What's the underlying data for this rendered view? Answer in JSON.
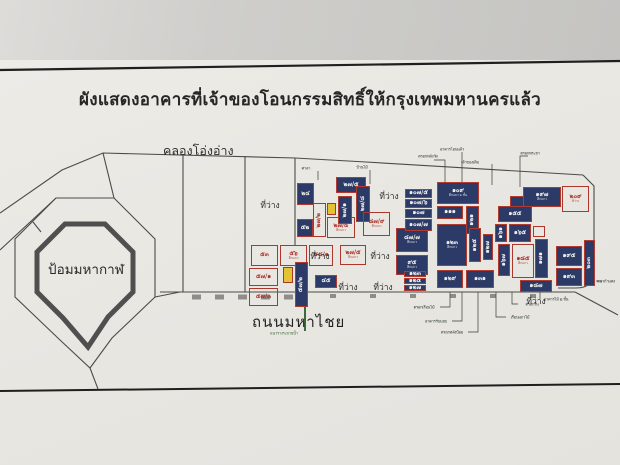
{
  "title": "ผังแสดงอาคารที่เจ้าของโอนกรรมสิทธิ์ให้กรุงเทพมหานครแล้ว",
  "labels": {
    "canal": "คลองโอ่งอ่าง",
    "fort": "ป้อมมหากาฬ",
    "road": "ถนนมหาไชย",
    "vacant": "ที่ว่าง"
  },
  "colors": {
    "navy_fill": "#2b3a66",
    "red_outline": "#ad372c",
    "yellow_highlight": "#e4c332",
    "line": "#4b4b49",
    "paper": "#e8e6e1",
    "wall": "#cbc9c6",
    "green_mark": "#3a6b3a"
  },
  "map": {
    "plots": [
      {
        "x": 297,
        "y": 183,
        "w": 17,
        "h": 22,
        "t": "n",
        "label": "๒๔"
      },
      {
        "x": 297,
        "y": 219,
        "w": 16,
        "h": 18,
        "t": "n",
        "label": "๕๒"
      },
      {
        "x": 313,
        "y": 203,
        "w": 13,
        "h": 34,
        "t": "r",
        "label": "๒๗/๒",
        "rot": 1
      },
      {
        "x": 327,
        "y": 203,
        "w": 9,
        "h": 12,
        "t": "y",
        "label": ""
      },
      {
        "x": 327,
        "y": 217,
        "w": 28,
        "h": 21,
        "t": "r",
        "label": "๒๗/๔",
        "sub": "ตึกแถว"
      },
      {
        "x": 336,
        "y": 177,
        "w": 30,
        "h": 16,
        "t": "n",
        "label": "๒๗/๕"
      },
      {
        "x": 338,
        "y": 196,
        "w": 14,
        "h": 28,
        "t": "n",
        "label": "๒๗/๑",
        "rot": 1
      },
      {
        "x": 251,
        "y": 245,
        "w": 27,
        "h": 21,
        "t": "r",
        "label": "๕๓"
      },
      {
        "x": 280,
        "y": 245,
        "w": 27,
        "h": 21,
        "t": "r",
        "label": "๕๖",
        "sub": "ตึกแถว"
      },
      {
        "x": 309,
        "y": 245,
        "w": 24,
        "h": 21,
        "t": "r",
        "label": "๕๘/๑"
      },
      {
        "x": 249,
        "y": 268,
        "w": 29,
        "h": 18,
        "t": "r",
        "label": "๕๗/๑"
      },
      {
        "x": 249,
        "y": 288,
        "w": 29,
        "h": 18,
        "t": "r",
        "label": "๕๗/๓"
      },
      {
        "x": 283,
        "y": 267,
        "w": 10,
        "h": 16,
        "t": "y",
        "label": ""
      },
      {
        "x": 295,
        "y": 262,
        "w": 13,
        "h": 45,
        "t": "n",
        "label": "๕๗/๒",
        "rot": 1
      },
      {
        "x": 340,
        "y": 245,
        "w": 26,
        "h": 20,
        "t": "r",
        "label": "๒๗/๕",
        "sub": "ตึกแถว"
      },
      {
        "x": 315,
        "y": 275,
        "w": 22,
        "h": 13,
        "t": "n",
        "label": "๔๕"
      },
      {
        "x": 356,
        "y": 186,
        "w": 14,
        "h": 36,
        "t": "n",
        "label": "๒๗/๘",
        "rot": 1
      },
      {
        "x": 363,
        "y": 212,
        "w": 27,
        "h": 24,
        "t": "r",
        "label": "๘๗/๙",
        "sub": "ตึกแถว"
      },
      {
        "x": 396,
        "y": 228,
        "w": 32,
        "h": 24,
        "t": "n",
        "label": "๘๗/๗",
        "sub": "ตึกแถว"
      },
      {
        "x": 396,
        "y": 255,
        "w": 32,
        "h": 20,
        "t": "n",
        "label": "๙๕",
        "sub": "ตึกแถว"
      },
      {
        "x": 405,
        "y": 189,
        "w": 27,
        "h": 9,
        "t": "n",
        "label": "๑๐๗/๕"
      },
      {
        "x": 405,
        "y": 199,
        "w": 27,
        "h": 9,
        "t": "n",
        "label": "๑๐๗/๖"
      },
      {
        "x": 405,
        "y": 209,
        "w": 27,
        "h": 9,
        "t": "n",
        "label": "๑๐๗"
      },
      {
        "x": 405,
        "y": 219,
        "w": 27,
        "h": 12,
        "t": "n",
        "label": "๑๐๗/๗"
      },
      {
        "x": 404,
        "y": 271,
        "w": 22,
        "h": 6,
        "t": "n",
        "label": "๑๒๓"
      },
      {
        "x": 404,
        "y": 278,
        "w": 22,
        "h": 6,
        "t": "n",
        "label": "๑๒๕"
      },
      {
        "x": 404,
        "y": 285,
        "w": 22,
        "h": 6,
        "t": "n",
        "label": "๑๒๗"
      },
      {
        "x": 437,
        "y": 182,
        "w": 42,
        "h": 22,
        "t": "n",
        "label": "๑๐๙",
        "sub": "ตึกแถว ๒ ชั้น"
      },
      {
        "x": 437,
        "y": 206,
        "w": 26,
        "h": 13,
        "t": "n",
        "label": "๑๑๑"
      },
      {
        "x": 466,
        "y": 206,
        "w": 13,
        "h": 28,
        "t": "n",
        "label": "๑๒๑",
        "rot": 1
      },
      {
        "x": 437,
        "y": 224,
        "w": 30,
        "h": 42,
        "t": "n",
        "label": "๑๒๓",
        "sub": "ตึกแถว"
      },
      {
        "x": 469,
        "y": 228,
        "w": 12,
        "h": 34,
        "t": "n",
        "label": "๑๒๕",
        "rot": 1
      },
      {
        "x": 483,
        "y": 234,
        "w": 10,
        "h": 26,
        "t": "n",
        "label": "๑๒๗",
        "rot": 1
      },
      {
        "x": 437,
        "y": 270,
        "w": 26,
        "h": 18,
        "t": "n",
        "label": "๑๒๙"
      },
      {
        "x": 466,
        "y": 270,
        "w": 28,
        "h": 18,
        "t": "n",
        "label": "๑๓๑"
      },
      {
        "x": 498,
        "y": 206,
        "w": 34,
        "h": 16,
        "t": "n",
        "label": "๑๕๕"
      },
      {
        "x": 495,
        "y": 224,
        "w": 12,
        "h": 18,
        "t": "n",
        "label": "๑๖๑",
        "rot": 1
      },
      {
        "x": 509,
        "y": 224,
        "w": 22,
        "h": 18,
        "t": "n",
        "label": "๑๖๕"
      },
      {
        "x": 533,
        "y": 226,
        "w": 12,
        "h": 11,
        "t": "r",
        "label": ""
      },
      {
        "x": 535,
        "y": 239,
        "w": 13,
        "h": 39,
        "t": "n",
        "label": "๑๗๑",
        "rot": 1
      },
      {
        "x": 498,
        "y": 244,
        "w": 12,
        "h": 32,
        "t": "n",
        "label": "๑๖๗",
        "rot": 1
      },
      {
        "x": 512,
        "y": 244,
        "w": 22,
        "h": 34,
        "t": "r",
        "label": "๑๘๕",
        "sub": "ตึกแถว"
      },
      {
        "x": 523,
        "y": 187,
        "w": 38,
        "h": 20,
        "t": "n",
        "label": "๑๙๗",
        "sub": "ตึกแถว"
      },
      {
        "x": 510,
        "y": 196,
        "w": 14,
        "h": 11,
        "t": "n",
        "label": ""
      },
      {
        "x": 562,
        "y": 186,
        "w": 27,
        "h": 26,
        "t": "r",
        "label": "๒๐๙",
        "sub": "ที่ว่าง"
      },
      {
        "x": 556,
        "y": 246,
        "w": 26,
        "h": 20,
        "t": "n",
        "label": "๑๙๕"
      },
      {
        "x": 556,
        "y": 268,
        "w": 26,
        "h": 18,
        "t": "n",
        "label": "๑๙๓"
      },
      {
        "x": 584,
        "y": 240,
        "w": 11,
        "h": 46,
        "t": "n",
        "label": "๒๐๓",
        "rot": 1
      },
      {
        "x": 520,
        "y": 280,
        "w": 32,
        "h": 12,
        "t": "n",
        "label": "๑๘๗"
      }
    ],
    "vacant_labels": [
      {
        "x": 270,
        "y": 205
      },
      {
        "x": 389,
        "y": 196
      },
      {
        "x": 320,
        "y": 256
      },
      {
        "x": 380,
        "y": 256
      },
      {
        "x": 348,
        "y": 287
      },
      {
        "x": 383,
        "y": 287
      },
      {
        "x": 536,
        "y": 301
      }
    ],
    "annotations": [
      {
        "x": 428,
        "y": 156,
        "text": "ตรอกหลังวัด"
      },
      {
        "x": 452,
        "y": 149,
        "text": "อาคารโอนแล้ว"
      },
      {
        "x": 470,
        "y": 162,
        "text": "เจ้าของเดิม"
      },
      {
        "x": 530,
        "y": 153,
        "text": "ตรอกพระยา"
      },
      {
        "x": 306,
        "y": 168,
        "text": "ศาลา"
      },
      {
        "x": 362,
        "y": 167,
        "text": "บ้านไม้"
      },
      {
        "x": 424,
        "y": 307,
        "text": "ตรอกเรือนไม้"
      },
      {
        "x": 436,
        "y": 321,
        "text": "อาคารรับมอบ"
      },
      {
        "x": 452,
        "y": 332,
        "text": "ตรอกหลังป้อม"
      },
      {
        "x": 520,
        "y": 317,
        "text": "เรือนแถวไม้"
      },
      {
        "x": 532,
        "y": 304,
        "text": "ตรอกใน"
      },
      {
        "x": 556,
        "y": 299,
        "text": "อาคารไม้ ๒ ชั้น"
      },
      {
        "x": 606,
        "y": 281,
        "text": "แนวกำแพง"
      },
      {
        "x": 284,
        "y": 333,
        "text": "แนวรางระบายน้ำ",
        "green": true
      }
    ]
  }
}
